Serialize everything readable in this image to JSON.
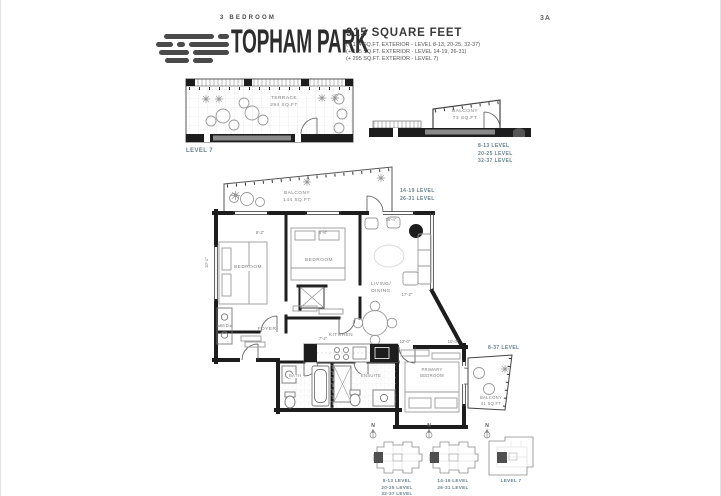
{
  "colors": {
    "accent_level_caption": "#66818D",
    "wall": "#1D1D1D",
    "heading_text": "#2D2D2D",
    "note_text": "#555555",
    "furniture_line": "#9A9A9A"
  },
  "header": {
    "plan_code": "3A",
    "bedroom_type": "3 BEDROOM",
    "project_name": "TOPHAM PARK",
    "area_title": "915 SQUARE FEET",
    "area_notes": [
      "(+ 114 SQ.FT. EXTERIOR - LEVEL 8-13, 20-25, 32-37)",
      "(+ 185 SQ.FT. EXTERIOR - LEVEL 14-19, 26-31)",
      "(+ 295 SQ.FT. EXTERIOR - LEVEL 7)"
    ]
  },
  "terrace_diagram": {
    "room": "TERRACE",
    "area": "294 SQ.FT",
    "caption": "LEVEL 7"
  },
  "balcony_diagram": {
    "room": "BALCONY",
    "area": "73 SQ.FT",
    "captions": [
      "8-13 LEVEL",
      "20-25 LEVEL",
      "32-37 LEVEL"
    ]
  },
  "floor_plan": {
    "balcony": {
      "room": "BALCONY",
      "area": "144 SQ.FT"
    },
    "balcony_captions": [
      "14-19 LEVEL",
      "26-31 LEVEL"
    ],
    "rooms": {
      "bedroom1": "BEDROOM",
      "bedroom2": "BEDROOM",
      "living_line1": "LIVING/",
      "living_line2": "DINING",
      "foyer": "FOYER",
      "kitchen": "KITCHEN",
      "bath": "BATH",
      "ensuite": "ENSUITE",
      "primary_line1": "PRIMARY",
      "primary_line2": "BEDROOM",
      "laundry": "W/D"
    },
    "small_balcony": {
      "room": "BALCONY",
      "area": "41 SQ.FT",
      "caption": "8-37 LEVEL"
    },
    "dimensions": {
      "bedroom1_w": "8'-2\"",
      "bedroom2_w": "8'-8\"",
      "living_w": "18'-4\"",
      "living_h": "17'-2\"",
      "kitchen_w": "7'-2\"",
      "primary_w": "12'-0\"",
      "primary_closet": "10'-0\"",
      "bedroom1_h": "10'-1\""
    }
  },
  "keyplans": [
    {
      "north": "N",
      "captions": [
        "8-13 LEVEL",
        "20-25 LEVEL",
        "32-37 LEVEL"
      ]
    },
    {
      "north": "N",
      "captions": [
        "14-19 LEVEL",
        "26-31 LEVEL"
      ]
    },
    {
      "north": "N",
      "captions": [
        "LEVEL 7"
      ]
    }
  ]
}
